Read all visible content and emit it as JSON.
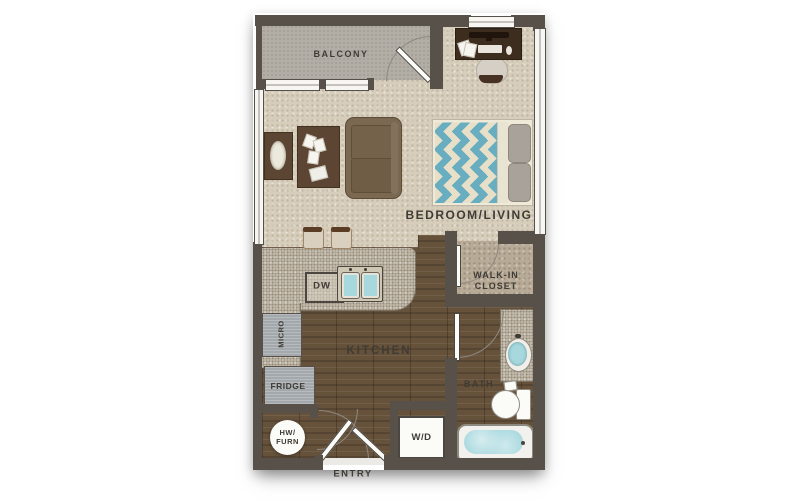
{
  "floorplan": {
    "labels": {
      "balcony": "BALCONY",
      "bedroom_living": "BEDROOM/LIVING",
      "kitchen": "KITCHEN",
      "walk_in_closet_l1": "WALK-IN",
      "walk_in_closet_l2": "CLOSET",
      "bath": "BATH",
      "entry": "ENTRY",
      "dw": "DW",
      "micro": "MICRO",
      "fridge": "FRIDGE",
      "wd": "W/D",
      "hw_furn_l1": "HW/",
      "hw_furn_l2": "FURN"
    },
    "colors": {
      "wall": "#57514a",
      "carpet": "#d7cdbb",
      "wood_base": "#66523b",
      "granite": "#c9c0ae",
      "balcony_floor": "#b2ada5",
      "closet_carpet": "#b7aa96",
      "water": "#a7d8de",
      "blanket_teal": "#68aec0",
      "blanket_cream": "#e7dfc7",
      "label": "#3f3b35",
      "appliance_gray": "#a3a8ac",
      "fixture_white": "#fbfbf8"
    }
  }
}
